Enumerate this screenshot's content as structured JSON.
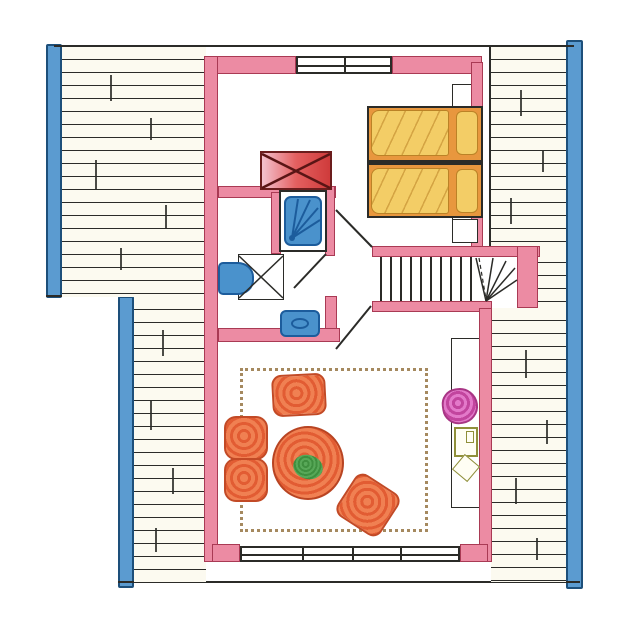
{
  "document": {
    "kind": "hand-drawn floor plan sketch",
    "floor": "attic-level apartment",
    "visible_text": []
  },
  "palette": {
    "paper": "#ffffff",
    "hatch_paper": "#fcfaf0",
    "line": "#2b2b28",
    "gutter_blue": "#5b9bd0",
    "gutter_blue_edge": "#1d4f7a",
    "wall_pink": "#ec8ba3",
    "wall_pink_edge": "#a93a54",
    "chimney_red": "#cf3b3b",
    "chimney_red_edge": "#6b1d1d",
    "fixture_blue": "#4a92cc",
    "fixture_blue_edge": "#1c5c9c",
    "bed_orange": "#e8973e",
    "bed_duvet_yellow": "#f3cd66",
    "bed_orange_edge": "#bb8226",
    "furniture_orange_light": "#f08052",
    "furniture_orange_dark": "#e25c33",
    "furniture_orange_edge": "#c24a26",
    "table_orange_edge": "#b84422",
    "plant_green": "#3f8f3f",
    "plant_pink_light": "#e379c9",
    "plant_pink_dark": "#c2459e",
    "plant_pink_edge": "#a83585",
    "cabinet_olive": "#8f8f3a",
    "rug_dot_brown": "#a5895f"
  },
  "rooms": [
    {
      "name": "bedroom",
      "position": "top-right",
      "fixtures": [
        "twin-beds",
        "nightstand",
        "chimney-flue"
      ]
    },
    {
      "name": "bathroom",
      "position": "center-left",
      "fixtures": [
        "shower",
        "toilet",
        "washbasin"
      ]
    },
    {
      "name": "hallway-landing",
      "position": "center",
      "fixtures": [
        "staircase",
        "three-doors"
      ]
    },
    {
      "name": "living-room",
      "position": "bottom",
      "fixtures": [
        "rug",
        "sofa",
        "armchair",
        "armchair",
        "round-table",
        "potted-plant",
        "cabinet"
      ]
    }
  ],
  "staircase": {
    "step_count": 10,
    "winder_count": 5,
    "turn": "quarter-turn right"
  },
  "windows": {
    "top_window_panes": 2,
    "bottom_window_panes": 4
  },
  "roof_hatch": {
    "line_spacing_px": 13,
    "orientation": "horizontal"
  }
}
